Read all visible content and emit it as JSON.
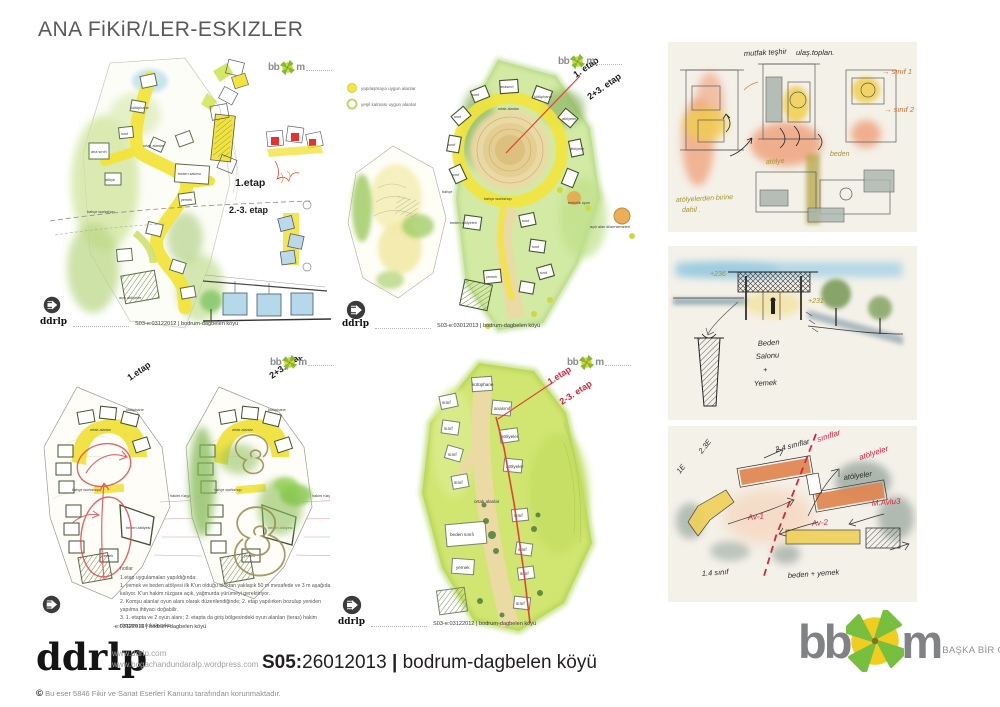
{
  "title": "ANA FiKiR/LER-ESKIZLER",
  "colors": {
    "path_yellow": "#f2e43c",
    "wash_green": "#b8d98a",
    "wash_blue": "#a9d3e4",
    "salmon": "#ef9f78",
    "red": "#e0413c",
    "crimson": "#d8243c",
    "cream_panel": "#f4f1e9",
    "logo_green": "#76bf3f",
    "logo_yellow": "#f0cd1f",
    "logo_gray": "#808285"
  },
  "panels": {
    "top_left": {
      "stage1": "1.etap",
      "stage23": "2.-3. etap",
      "caption": "S03-e:03122012 | bodrum-dagbelen köyü",
      "labels": {
        "sinif": "sınıf",
        "ana_sinif": "ana sınıfı",
        "kutuphane": "kütüphane",
        "ortak": "ortak alanlar",
        "beden": "beden salonu",
        "yemek": "yemek",
        "atolye": "atölye",
        "bahce_workshop": "bahçe workshop",
        "acik_atolyeler": "açık atölyeler"
      }
    },
    "top_middle": {
      "legend1": "yapılaşmaya uygun alanlar",
      "legend2": "yeşil kalması uygun alanlar",
      "stage1": "1. etap",
      "stage23": "2+3. etap",
      "caption": "S03-e:03012013 | bodrum-dagbelen köyü",
      "labels": {
        "anasinif": "anasınıf",
        "kutuphane": "kütüphane",
        "ortak": "ortak alanlar",
        "sinif": "sınıf",
        "atolyeler": "atölyeler",
        "bahce": "bahçe",
        "bahce_workshop": "bahçe workshop",
        "beden": "beden atölyeleri",
        "temizlik": "temizlik oyun",
        "acik_alan": "açık alan düzenlemeleri",
        "yemek": "yemek"
      }
    },
    "bottom_left": {
      "stage1": "1.etap",
      "stage23": "2+3. etap",
      "caption": "-e:03122012 | bodrum-dagbelen köyü",
      "labels": {
        "ortak": "ortak alanlar",
        "kutuphane": "kütüphane",
        "sinif": "sınıf",
        "bahce_workshop": "bahçe workshop",
        "beden": "beden atölyesi",
        "yemek": "yemek",
        "hakim": "hakim rüzgar"
      },
      "notes_title": "notlar",
      "notes": [
        "1.etap uygulamaları yapıldığında:",
        "1. yemek ve beden atölyesi ilk K'un olduğu bloktan yaklaşık 50 m mesafede ve 3 m aşağıda",
        "kalıyor. K'un hakim rüzgara açık, yağmurda yürümeyi gerektiriyor.",
        "2. Komşu alanlar oyun alanı olarak düzenlendiğinde; 2. etap yapılırken bozulup yeniden",
        "yapılma ihtiyacı doğabilir.",
        "3. 1. etapta ve 2 oyun alanı; 2. etapta da giriş bölgesindeki oyun alanları (teras) hakim",
        "rüzgara açık kalıyorlar."
      ]
    },
    "bottom_middle": {
      "stage1": "1.etap",
      "stage23": "2-3. etap",
      "caption": "S03-e:03122012 | bodrum-dagbelen köyü",
      "labels": {
        "kutuphane": "kütüphane",
        "sinif": "sınıf",
        "anasinif": "anasınıf",
        "atolyeler": "atölyeler",
        "ortak": "ortak alanlar",
        "beden": "beden sınıfı",
        "yemek": "yemek"
      }
    }
  },
  "sketches": {
    "panel1": {
      "mutfak": "mutfak teşhir",
      "ulas": "ulaş.toplan.",
      "sinif1": "→ sınıf 1",
      "sinif2": "→ sınıf 2",
      "atolye": "atölye",
      "beden": "beden",
      "dahil1": "atölyelerden birine",
      "dahil2": "dahil ."
    },
    "panel2": {
      "lvl1": "+236",
      "lvl2": "+231",
      "line1": "Beden",
      "line2": "Salonu",
      "line3": "+",
      "line4": "Yemek"
    },
    "panel3": {
      "red1": "sınıflar",
      "red2": "atölyeler",
      "red3": "M.Avlu3",
      "av1": "Av-1",
      "av2": "Av-2",
      "e1": "1E",
      "e23": "2.3E",
      "s24": "2.4 sınıflar",
      "atolyeler": "atölyeler",
      "s14": "1.4 sınıf",
      "beden": "beden + yemek"
    }
  },
  "footer": {
    "ddrlp": "ddrlp",
    "url1": "www.ddrlp.com",
    "url2": "www.bogachandundaralp.wordpress.com",
    "copyright": "Bu eser 5846 Fikir ve Sanat Eserleri Kanunu tarafından korunmaktadır.",
    "caption_code": "S05:",
    "caption_date": "26012013",
    "caption_sep": "|",
    "caption_place": "bodrum-dagbelen köyü",
    "bbom_bb": "bb",
    "bbom_m": "m",
    "bbom_tagline": "BAŞKA BİR OKUL MÜMKÜN"
  },
  "mini_logo": {
    "bb": "bb",
    "m": "m",
    "ddrlp": "ddrlp"
  }
}
